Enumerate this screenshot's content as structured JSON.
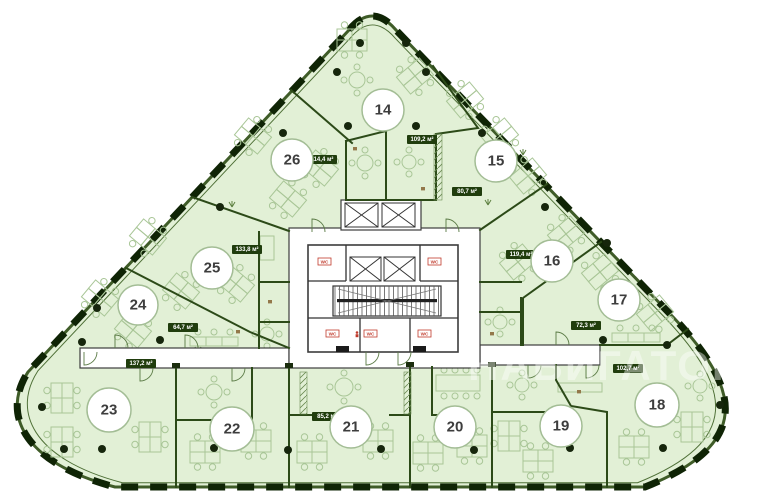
{
  "plan": {
    "watermark": "НАВИГАТОР",
    "core": {
      "wc_left": "WC",
      "wc_right": "WC",
      "wc_bottom_1": "WC",
      "wc_bottom_2": "WC",
      "wc_bottom_3": "WC"
    },
    "colors": {
      "floor": "#e2f0d6",
      "wall": "#2c4a18",
      "outer_dash": "#0f2405",
      "badge": "#203d0d",
      "accent_red": "#c03a2b",
      "furniture": "#a9c697"
    },
    "rooms": [
      {
        "number": "14",
        "area": "109,2 м²"
      },
      {
        "number": "15",
        "area": "80,7 м²"
      },
      {
        "number": "16",
        "area": "119,4 м²"
      },
      {
        "number": "17",
        "area": "72,3 м²"
      },
      {
        "number": "18",
        "area": "102,7 м²"
      },
      {
        "number": "19",
        "area": null
      },
      {
        "number": "20",
        "area": null
      },
      {
        "number": "21",
        "area": "85,2 м²"
      },
      {
        "number": "22",
        "area": null
      },
      {
        "number": "23",
        "area": "137,2 м²"
      },
      {
        "number": "24",
        "area": "64,7 м²"
      },
      {
        "number": "25",
        "area": "133,8 м²"
      },
      {
        "number": "26",
        "area": "114,4 м²"
      }
    ]
  }
}
